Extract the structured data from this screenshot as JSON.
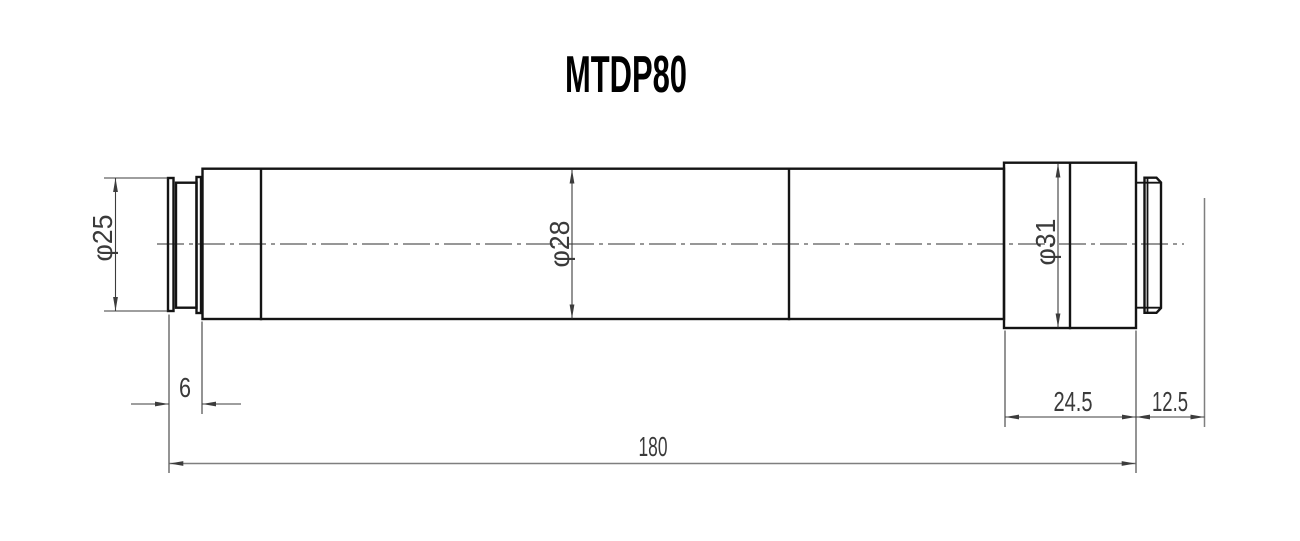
{
  "title": "MTDP80",
  "dims": {
    "front_od": {
      "label": "φ25",
      "value": 25,
      "type": "diameter"
    },
    "body_od": {
      "label": "φ28",
      "value": 28,
      "type": "diameter"
    },
    "rear_od": {
      "label": "φ31",
      "value": 31,
      "type": "diameter"
    },
    "front_len": {
      "label": "6",
      "value": 6,
      "type": "length"
    },
    "rear_block_len": {
      "label": "24.5",
      "value": 24.5,
      "type": "length"
    },
    "rear_end_len": {
      "label": "12.5",
      "value": 12.5,
      "type": "length"
    },
    "overall_len": {
      "label": "180",
      "value": 180,
      "type": "length"
    }
  },
  "colors": {
    "background": "#ffffff",
    "outline": "#141414",
    "centerline": "#2f2f2f",
    "dimension": "#3c3c3c",
    "dimension_light": "#7f7f7f",
    "text": "#3a3a3a",
    "title_text": "#000000"
  }
}
